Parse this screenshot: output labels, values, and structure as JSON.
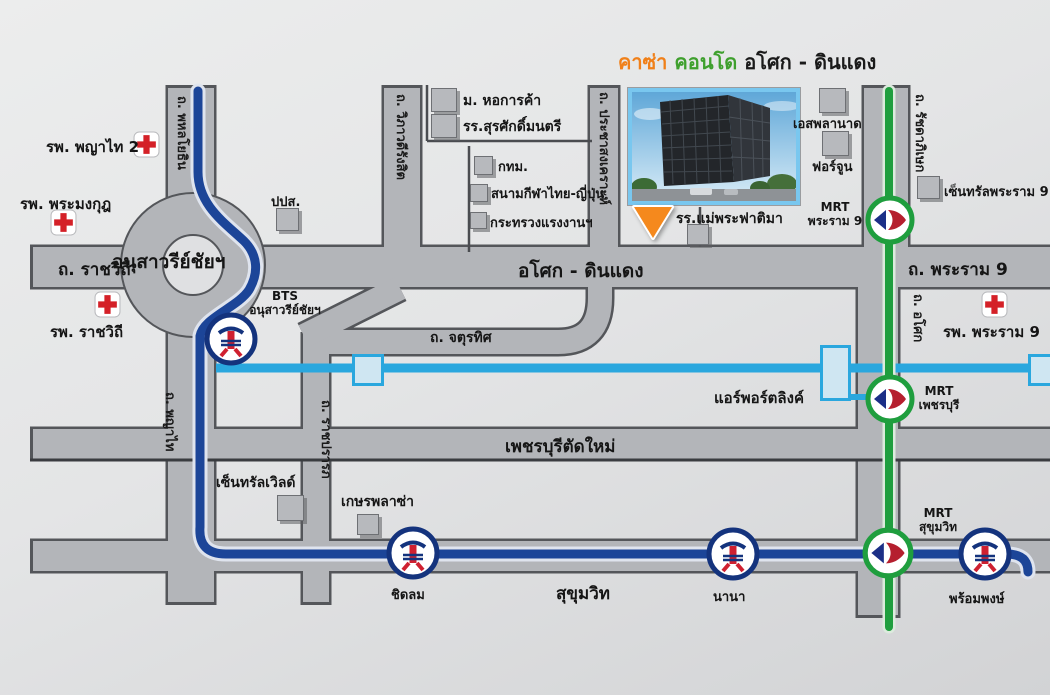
{
  "title": {
    "brand": "คาซ่า",
    "word_condo": "คอนโด",
    "location": "อโศก - ดินแดง"
  },
  "roads": {
    "ratchawithi": "ถ. ราชวิถี",
    "victory_monument": "อนุสาวรีย์ชัยฯ",
    "asoke_dindaeng": "อโศก - ดินแดง",
    "rama9": "ถ. พระราม 9",
    "phahonyothin": "ถ. พหลโยธิน",
    "phayathai": "ถ. พญาไท",
    "vibhavadi": "ถ. วิภาวดีรังสิต",
    "prachasongkhro": "ถ. ประชาสงเคราะห์",
    "ratchadaphisek": "ถ. รัชดาภิเษก",
    "asoke": "ถ. อโศก",
    "chaturathit": "ถ. จตุรทิศ",
    "ratchaprarop": "ถ. ราชปรารภ",
    "phetchaburi": "เพชรบุรีตัดใหม่",
    "sukhumvit": "สุขุมวิท",
    "airport_link": "แอร์พอร์ตลิงค์"
  },
  "stations": {
    "bts_victory": {
      "line": "BTS",
      "name": "อนุสาวรีย์ชัยฯ"
    },
    "mrt_rama9": {
      "line": "MRT",
      "name": "พระราม 9"
    },
    "mrt_phetchaburi": {
      "line": "MRT",
      "name": "เพชรบุรี"
    },
    "mrt_sukhumvit": {
      "line": "MRT",
      "name": "สุขุมวิท"
    },
    "bts_chidlom": {
      "name": "ชิดลม"
    },
    "bts_nana": {
      "name": "นานา"
    },
    "bts_phromphong": {
      "name": "พร้อมพงษ์"
    }
  },
  "hospitals": [
    {
      "name": "รพ. พญาไท 2"
    },
    {
      "name": "รพ. พระมงกุฎ"
    },
    {
      "name": "รพ. ราชวิถี"
    },
    {
      "name": "รพ. พระราม 9"
    }
  ],
  "landmarks": {
    "utcc": "ม. หอการค้า",
    "surasakmontree": "รร.สุรศักดิ์มนตรี",
    "bma": "กทม.",
    "thai_japan_stadium": "สนามกีฬาไทย-ญี่ปุ่น",
    "ministry_of_labour": "กระทรวงแรงงานฯ",
    "oncb": "ปปส.",
    "fatima_school": "รร.แม่พระฟาติมา",
    "esplanade": "เอสพลานาด",
    "fortune": "ฟอร์จูน",
    "central_rama9": "เซ็นทรัลพระราม 9",
    "central_world": "เซ็นทรัลเวิลด์",
    "gaysorn_plaza": "เกษรพลาซ่า"
  },
  "colors": {
    "bts_line": "#1c4598",
    "mrt_line": "#1f9e3e",
    "airport_link_line": "#2aa7de",
    "road_gray": "#b3b5b9",
    "cross_red": "#d42027",
    "marker_orange": "#f5891d",
    "brand_orange": "#f08019",
    "brand_green": "#3fa02e"
  }
}
